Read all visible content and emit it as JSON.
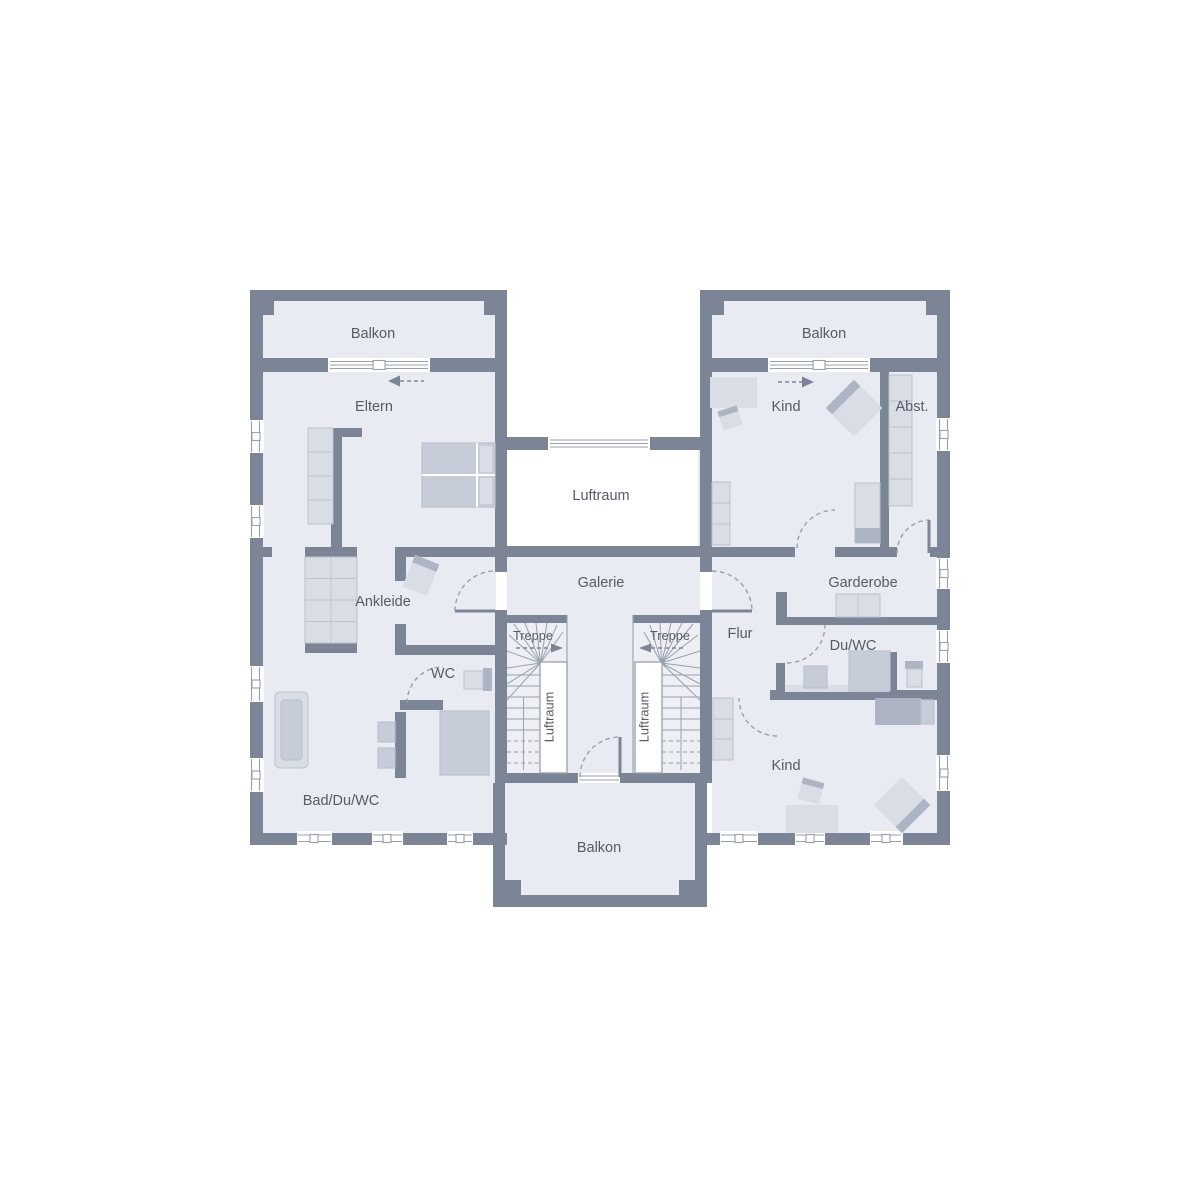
{
  "labels": {
    "balkon_top_left": "Balkon",
    "balkon_top_right": "Balkon",
    "balkon_bottom": "Balkon",
    "eltern": "Eltern",
    "kind_top": "Kind",
    "kind_bottom": "Kind",
    "abstellraum": "Abst.",
    "luftraum_center": "Luftraum",
    "luftraum_stair_left": "Luftraum",
    "luftraum_stair_right": "Luftraum",
    "galerie": "Galerie",
    "ankleide": "Ankleide",
    "treppe_left": "Treppe",
    "treppe_right": "Treppe",
    "flur": "Flur",
    "garderobe": "Garderobe",
    "du_wc": "Du/WC",
    "wc": "WC",
    "bad_du_wc": "Bad/Du/WC"
  },
  "colors": {
    "wall": "#7c8596",
    "floor": "#e8ebf1",
    "stair_floor": "#edeff4",
    "void": "#ffffff",
    "line": "#97a0af",
    "text": "#555b67",
    "furniture_light": "#d9dde6",
    "furniture_medium": "#c6ccd8",
    "furniture_dark": "#adb4c3",
    "furniture_border": "#bcc2cf"
  }
}
